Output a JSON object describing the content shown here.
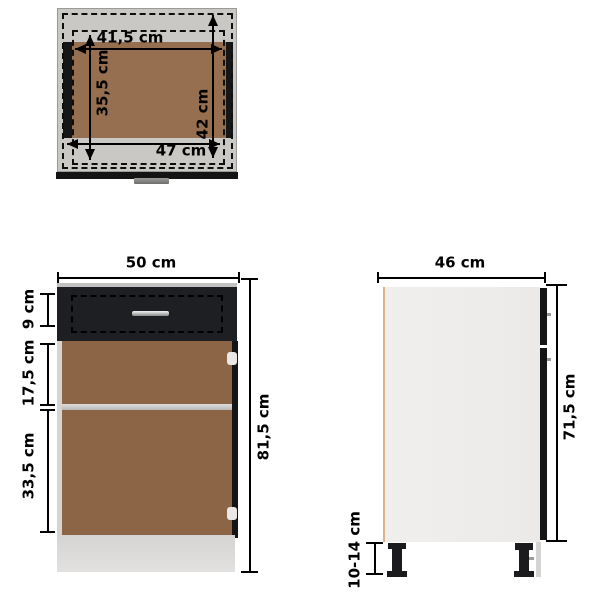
{
  "unit": "cm",
  "views": {
    "top": {
      "title": "drawer-top-view",
      "dims": {
        "inner_width": "41,5 cm",
        "inner_depth": "35,5 cm",
        "drawer_depth": "42 cm",
        "outer_width": "47 cm"
      }
    },
    "front": {
      "title": "cabinet-front-view",
      "dims": {
        "width": "50 cm",
        "drawer_height": "9 cm",
        "top_compartment": "17,5 cm",
        "bottom_compartment": "33,5 cm",
        "total_height": "81,5 cm"
      }
    },
    "side": {
      "title": "cabinet-side-view",
      "dims": {
        "depth": "46 cm",
        "carcass_height": "71,5 cm",
        "leg_height": "10-14 cm"
      }
    }
  },
  "colors": {
    "background": "#ffffff",
    "dimension_line": "#000000",
    "carcass_gray": "#c9c8c5",
    "wood_interior_top": "#956f4f",
    "wood_interior_front": "#8c6547",
    "panel_black": "#1a1b1d",
    "base_gray": "#d8d7d5",
    "side_body_white": "#eeedeb",
    "handle_chrome": "#c0c0c0",
    "hinge_white": "#e9e8e6"
  }
}
